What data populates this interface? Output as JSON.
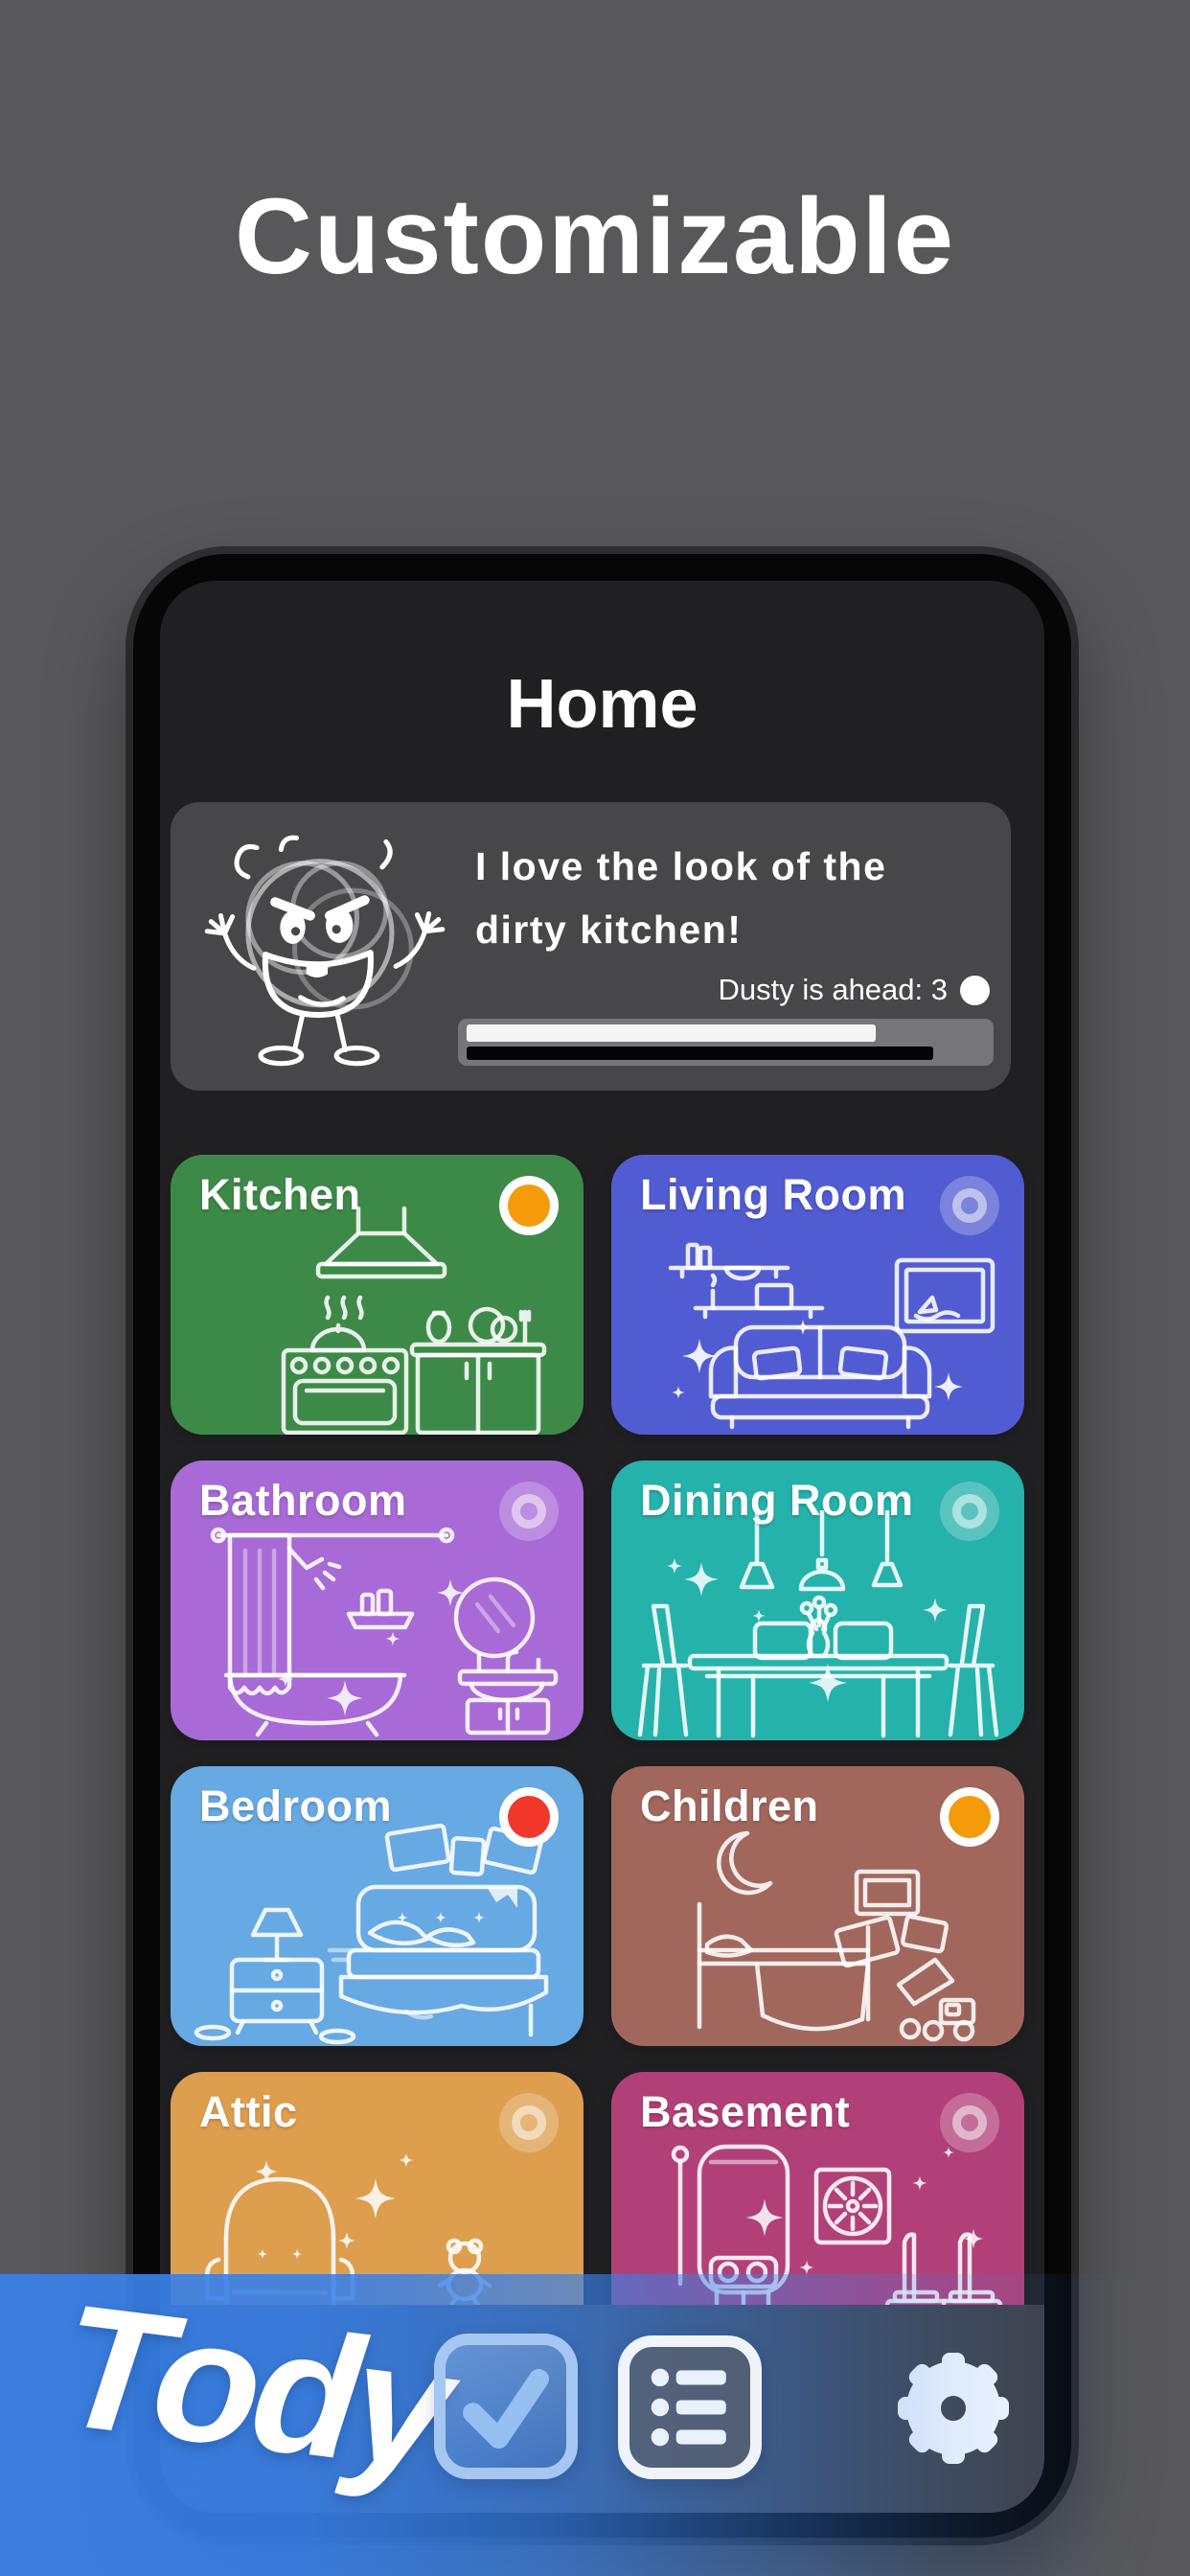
{
  "hero": {
    "title": "Customizable"
  },
  "app": {
    "header": {
      "title": "Home"
    },
    "dusty_card": {
      "quote_line1": "I love the look of the",
      "quote_line2": "dirty kitchen!",
      "status_text": "Dusty is ahead: 3",
      "progress": {
        "user_pct": 79,
        "dusty_pct": 90
      },
      "colors": {
        "card_bg": "#47474a",
        "track": "#76767a",
        "user_bar": "#f5f5f5",
        "dusty_bar": "#050505"
      }
    },
    "rooms": [
      {
        "name": "Kitchen",
        "color": "#3d8a48",
        "indicator": "orange"
      },
      {
        "name": "Living Room",
        "color": "#525cd2",
        "indicator": "none"
      },
      {
        "name": "Bathroom",
        "color": "#a86ad6",
        "indicator": "none"
      },
      {
        "name": "Dining Room",
        "color": "#25b2ab",
        "indicator": "none"
      },
      {
        "name": "Bedroom",
        "color": "#67a9e2",
        "indicator": "red"
      },
      {
        "name": "Children",
        "color": "#a2675c",
        "indicator": "orange"
      },
      {
        "name": "Attic",
        "color": "#dd9e4e",
        "indicator": "none"
      },
      {
        "name": "Basement",
        "color": "#b24078",
        "indicator": "none"
      }
    ],
    "indicator_colors": {
      "orange": "#f59b0a",
      "red": "#f2372b"
    }
  },
  "branding": {
    "logo_text": "Tody",
    "banner_color": "#3880e8",
    "icons": {
      "check_app": "checkmark-app-icon",
      "list_app": "task-list-app-icon",
      "settings": "gear-icon",
      "dusty_marker": "white-dot-icon"
    }
  }
}
